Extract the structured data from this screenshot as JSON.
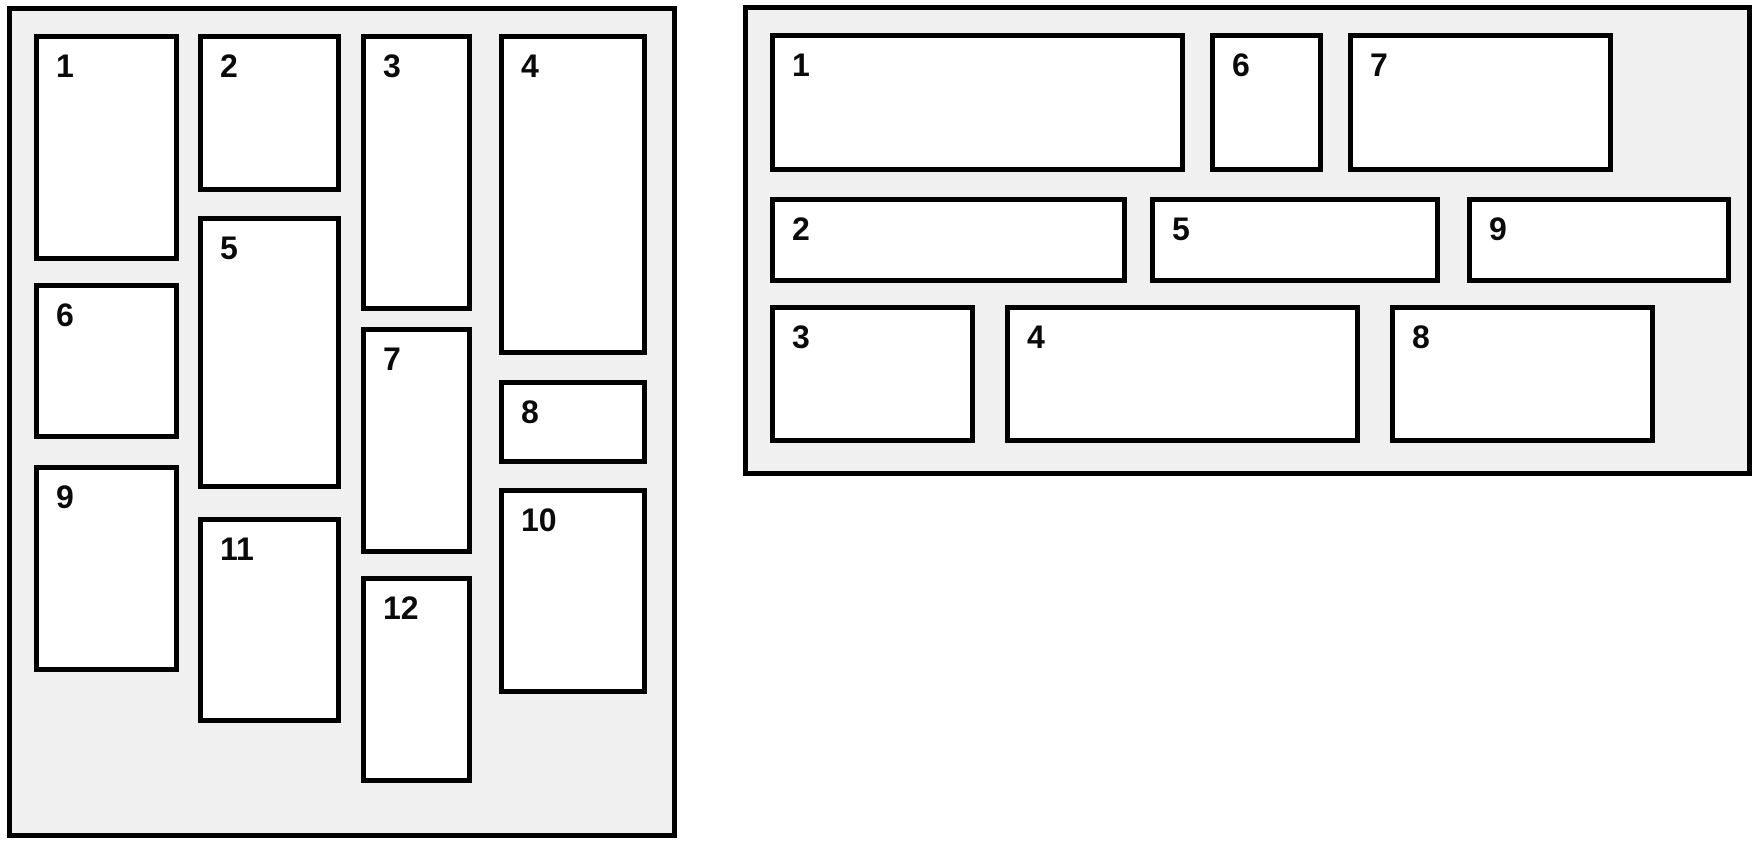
{
  "colors": {
    "page_background": "#ffffff",
    "container_fill": "#f0f0f0",
    "box_fill": "#ffffff",
    "border": "#000000",
    "label_text": "#0a0a0a"
  },
  "masonry_panel": {
    "name": "masonry-layout-panel",
    "frame": {
      "left": 7,
      "top": 6,
      "width": 670,
      "height": 832
    },
    "items": [
      {
        "label": "1",
        "x": 27,
        "y": 28,
        "w": 145,
        "h": 227
      },
      {
        "label": "2",
        "x": 191,
        "y": 28,
        "w": 143,
        "h": 158
      },
      {
        "label": "3",
        "x": 354,
        "y": 28,
        "w": 111,
        "h": 277
      },
      {
        "label": "4",
        "x": 492,
        "y": 28,
        "w": 148,
        "h": 321
      },
      {
        "label": "5",
        "x": 191,
        "y": 210,
        "w": 143,
        "h": 273
      },
      {
        "label": "6",
        "x": 27,
        "y": 277,
        "w": 145,
        "h": 156
      },
      {
        "label": "7",
        "x": 354,
        "y": 321,
        "w": 111,
        "h": 227
      },
      {
        "label": "8",
        "x": 492,
        "y": 374,
        "w": 148,
        "h": 84
      },
      {
        "label": "9",
        "x": 27,
        "y": 459,
        "w": 145,
        "h": 207
      },
      {
        "label": "10",
        "x": 492,
        "y": 482,
        "w": 148,
        "h": 206
      },
      {
        "label": "11",
        "x": 191,
        "y": 511,
        "w": 143,
        "h": 206
      },
      {
        "label": "12",
        "x": 354,
        "y": 570,
        "w": 111,
        "h": 207
      }
    ]
  },
  "flow_panel": {
    "name": "flow-layout-panel",
    "frame": {
      "left": 743,
      "top": 5,
      "width": 1009,
      "height": 471
    },
    "items": [
      {
        "label": "1",
        "x": 27,
        "y": 28,
        "w": 415,
        "h": 139
      },
      {
        "label": "2",
        "x": 27,
        "y": 192,
        "w": 357,
        "h": 86
      },
      {
        "label": "3",
        "x": 27,
        "y": 300,
        "w": 205,
        "h": 138
      },
      {
        "label": "4",
        "x": 262,
        "y": 300,
        "w": 355,
        "h": 138
      },
      {
        "label": "5",
        "x": 407,
        "y": 192,
        "w": 290,
        "h": 86
      },
      {
        "label": "6",
        "x": 467,
        "y": 28,
        "w": 113,
        "h": 139
      },
      {
        "label": "7",
        "x": 605,
        "y": 28,
        "w": 265,
        "h": 139
      },
      {
        "label": "8",
        "x": 647,
        "y": 300,
        "w": 265,
        "h": 138
      },
      {
        "label": "9",
        "x": 724,
        "y": 192,
        "w": 264,
        "h": 86
      }
    ]
  }
}
